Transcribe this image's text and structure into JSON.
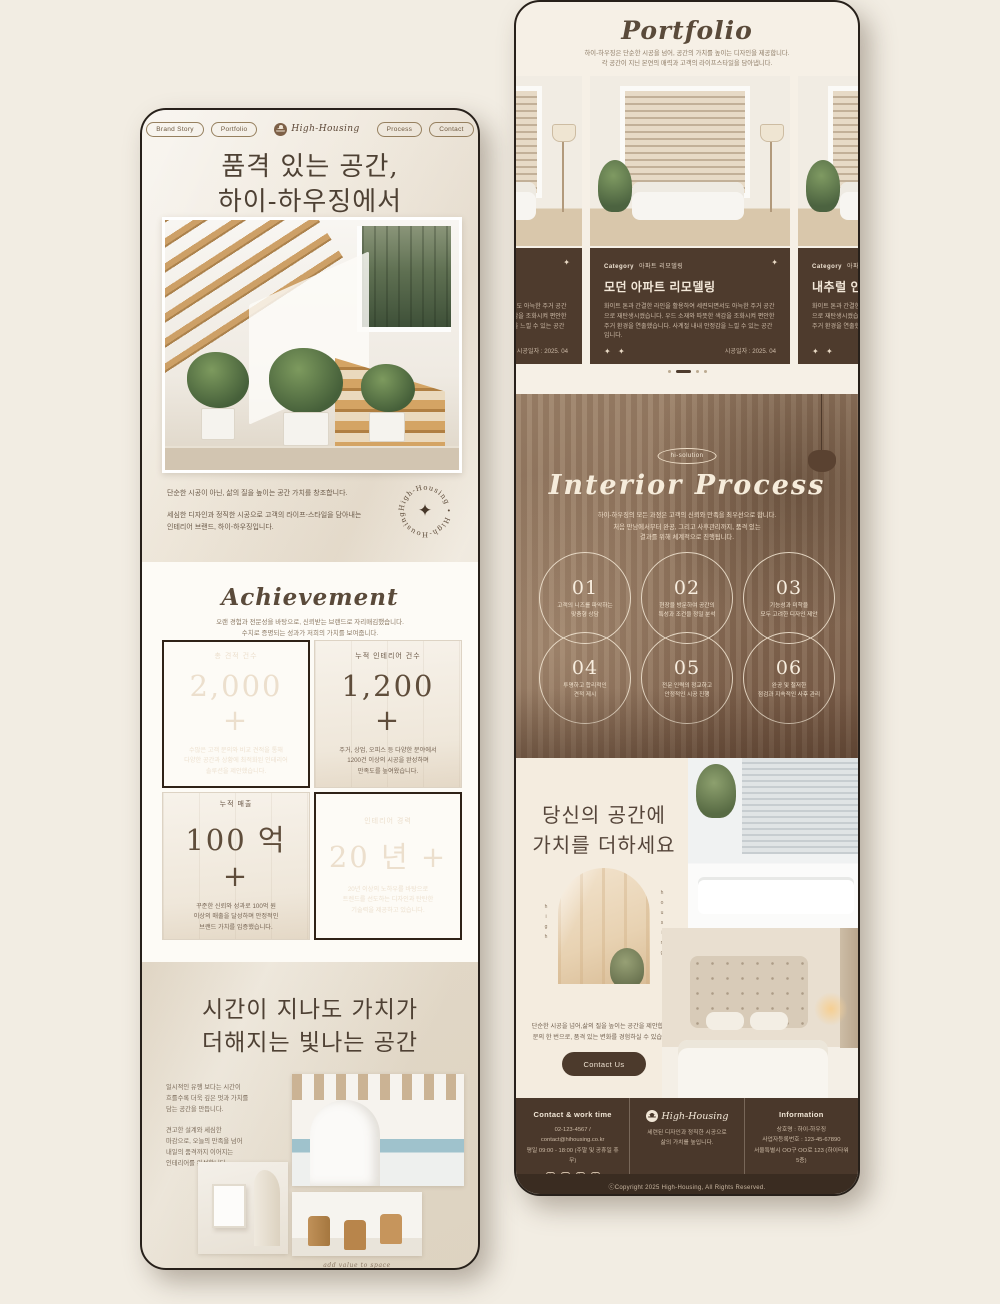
{
  "colors": {
    "accent_dark": "#4a382b",
    "cream": "#f4ecdf",
    "card_brown": "#4e3b2d",
    "text_brown": "#5a4a3a"
  },
  "left_page": {
    "nav": {
      "brand_story": "Brand Story",
      "portfolio": "Portfolio",
      "brand": "High-Housing",
      "process": "Process",
      "contact": "Contact"
    },
    "hero": {
      "title": "품격 있는 공간,\n하이-하우징에서",
      "para1": "단순한 시공이 아닌, 삶의 질을 높이는 공간 가치를 창조합니다.",
      "para2": "세심한 디자인과 정직한 시공으로 고객의 라이프-스타일을 담아내는\n인테리어 브랜드, 하이-하우징입니다.",
      "badge_ring_text": "High-Housing • High-Housing •"
    },
    "achievement": {
      "title": "Achievement",
      "subtitle": "오랜 경험과 전문성을 바탕으로, 신뢰받는 브랜드로 자리매김했습니다.\n수치로 증명되는 성과가 저희의 가치를 보여줍니다.",
      "cards": [
        {
          "label": "총 견적 건수",
          "value": "2,000 +",
          "desc": "수많은 고객 문의와 비교 견적을 통해\n다양한 공간과 상황에 최적화된 인테리어\n솔루션을 제안했습니다."
        },
        {
          "label": "누적 인테리어 건수",
          "value": "1,200 +",
          "desc": "주거, 상업, 오피스 등 다양한 분야에서\n1200건 이상의 시공을 완성하며\n만족도를 높여왔습니다."
        },
        {
          "label": "누적 매출",
          "value": "100 억 +",
          "desc": "꾸준한 신뢰와 성과로 100억 원\n이상의 매출을 달성하며 안정적인\n브랜드 가치를 입증했습니다."
        },
        {
          "label": "인테리어 경력",
          "value": "20 년 +",
          "desc": "20년 이상의 노하우를 바탕으로\n트렌드를 선도하는 디자인과 탄탄한\n기술력을 제공하고 있습니다."
        }
      ]
    },
    "value": {
      "title": "시간이 지나도 가치가\n더해지는 빛나는 공간",
      "para1": "일시적인 유행 보다는 시간이\n흐를수록 더욱 깊은 멋과 가치를\n담는 공간을 만듭니다.",
      "para2": "견고한 설계와 세심한\n마감으로, 오늘의 만족을 넘어\n내일의 품격까지 이어지는\n인테리어를 완성합니다.",
      "caption": "add value to space"
    }
  },
  "right_page": {
    "portfolio": {
      "title": "Portfolio",
      "subtitle": "하이-하우징은 단순한 시공을 넘어, 공간의 가치를 높이는 디자인을 제공합니다.\n각 공간이 지닌 본연의 매력과 고객의 라이프스타일을 담아냅니다.",
      "cards": [
        {
          "category_label": "Category",
          "category": "아파트 리모델링",
          "title": "모던 아파트 리모델링",
          "body": "화이트 톤과 간결한 라인을 활용하여 세련되면서도 아늑한 주거 공간으로 재탄생시켰습니다. 우드 소재와 따뜻한 색감을 조화시켜 편안한 주거 환경을 연출했습니다. 사계절 내내 안정감을 느낄 수 있는 공간입니다.",
          "date": "시공일자 : 2025. 04"
        },
        {
          "category_label": "Category",
          "category": "아파트 리모델링",
          "title": "모던 아파트 리모델링",
          "body": "화이트 톤과 간결한 라인을 활용하여 세련되면서도 아늑한 주거 공간으로 재탄생시켰습니다. 우드 소재와 따뜻한 색감을 조화시켜 편안한 주거 환경을 연출했습니다. 사계절 내내 안정감을 느낄 수 있는 공간입니다.",
          "date": "시공일자 : 2025. 04"
        },
        {
          "category_label": "Category",
          "category": "아파트 리모델링",
          "title": "내추럴 인테리어",
          "body": "화이트 톤과 간결한 라인을 활용하여 세련되면서도 아늑한 주거 공간으로 재탄생시켰습니다. 우드 소재와 따뜻한 색감을 조화시켜 편안한 주거 환경을 연출했습니다.",
          "date": "시공일자 : 2025. 04"
        }
      ]
    },
    "process": {
      "badge": "hi-solution",
      "title": "Interior Process",
      "sub1": "하이-하우징의 모든 과정은 고객의 신뢰와 만족을 최우선으로 합니다.",
      "sub2": "처음 만남에서부터 완공, 그리고 사후관리까지, 품격 있는\n결과를 위해 체계적으로 진행됩니다.",
      "steps": [
        {
          "num": "01",
          "caption": "고객의 니즈를 파악하는\n맞춤형 상담"
        },
        {
          "num": "02",
          "caption": "현장을 방문하여 공간의\n특성과 조건을 정밀 분석"
        },
        {
          "num": "03",
          "caption": "기능성과 미학을\n모두 고려한 디자인 제안"
        },
        {
          "num": "04",
          "caption": "투명하고 합리적인\n견적 제시"
        },
        {
          "num": "05",
          "caption": "전문 인력의 정교하고\n안정적인 시공 진행"
        },
        {
          "num": "06",
          "caption": "완공 및 철저한\n점검과 지속적인 사후 관리"
        }
      ]
    },
    "cta": {
      "title": "당신의 공간에\n가치를 더하세요",
      "vertical_left": "high",
      "vertical_right": "housing",
      "para": "단순한 시공을 넘어,삶의 질을 높이는 공간을 제안합니다.\n문의 한 번으로, 품격 있는 변화를 경험하실 수 있습니다.",
      "button": "Contact Us"
    },
    "footer": {
      "contact_title": "Contact & work time",
      "contact_line1": "02-123-4567 / contact@hihousing.co.kr",
      "contact_line2": "평일 09:00 - 18:00 (주말 및 공휴일 휴무)",
      "brand": "High-Housing",
      "brand_tagline": "세련된 디자인과 정직한 시공으로\n삶의 가치를 높입니다.",
      "info_title": "Information",
      "info_line1": "상호명 : 하이-하우징",
      "info_line2": "사업자등록번호 : 123-45-67890",
      "info_line3": "서울특별시 OO구 OO로 123 (하이타워 5층)",
      "copyright": "ⓒCopyright 2025 High-Housing, All Rights Reserved."
    }
  }
}
